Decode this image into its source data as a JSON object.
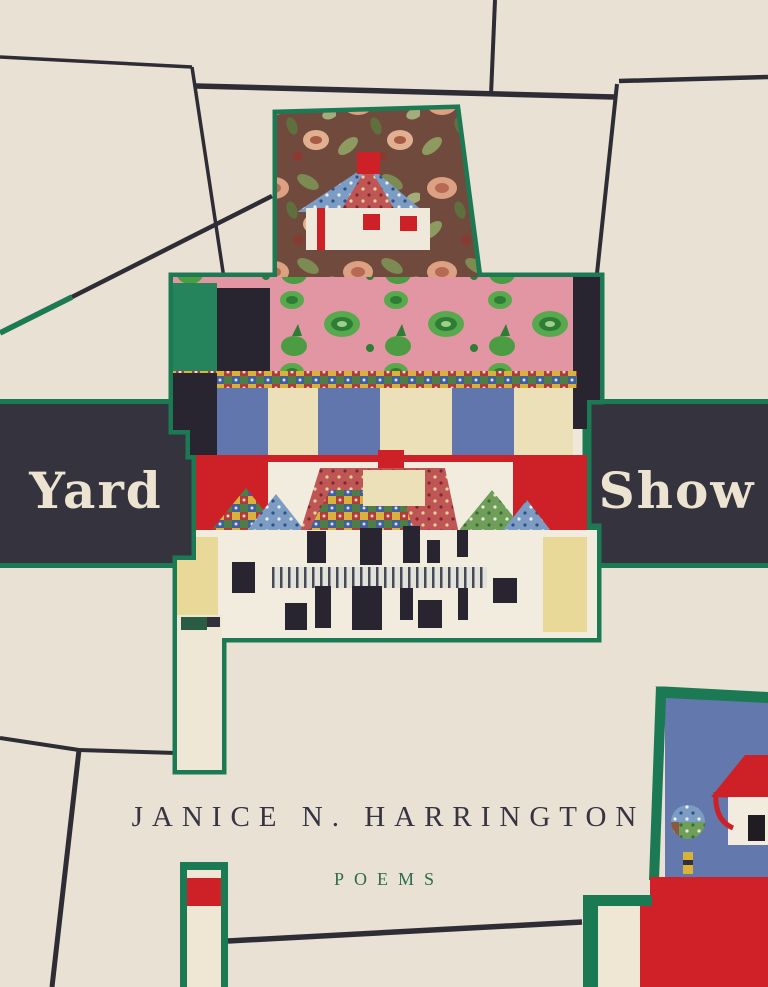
{
  "cover": {
    "title_left": "Yard",
    "title_right": "Show",
    "author": "JANICE N. HARRINGTON",
    "genre": "POEMS"
  },
  "colors": {
    "background_cream": "#e9e1d3",
    "band_navy": "#35333d",
    "line_navy": "#2e2c35",
    "quilt_border_green": "#1b7a53",
    "genre_green": "#2e6b4f",
    "title_cream": "#ece4d1",
    "fabric_red": "#cd2127",
    "fabric_pink": "#e295a3",
    "fabric_blue": "#6378ad",
    "fabric_yellow": "#e9d998",
    "fabric_black": "#282430",
    "fabric_white": "#f2ecdf",
    "floral_brown": "#6f4a3d"
  },
  "artwork": {
    "center_piece": "house-quilt-collage",
    "corner_pieces": [
      "bottom-left-quilt-strip",
      "bottom-right-quilt-fragment"
    ]
  }
}
